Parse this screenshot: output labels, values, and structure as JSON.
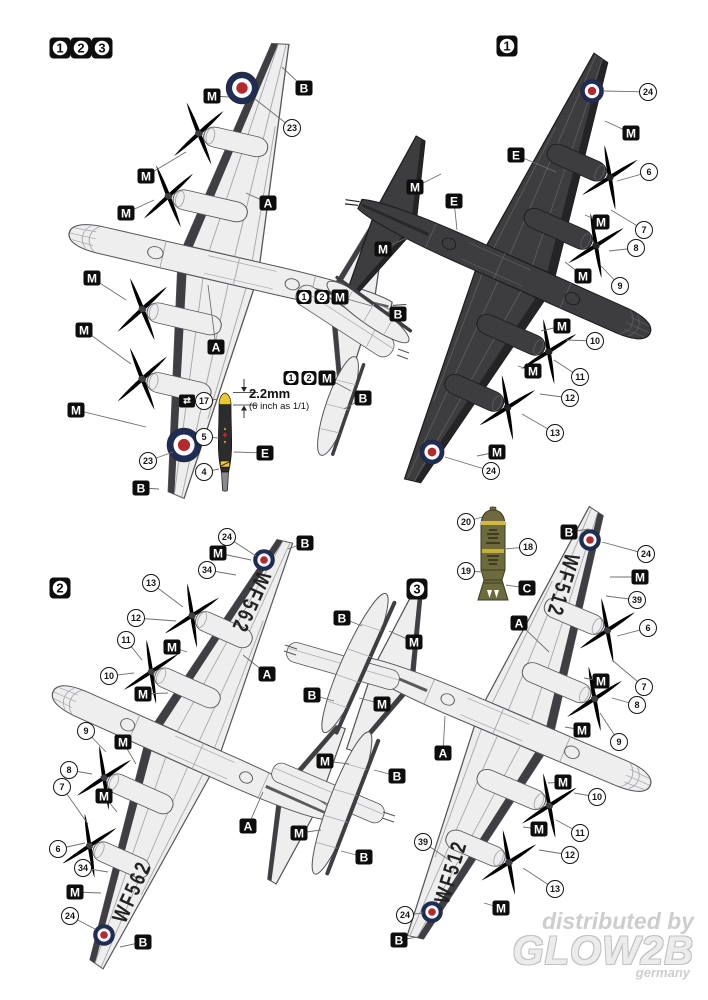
{
  "colors": {
    "page_bg": "#ffffff",
    "plane_light": "#eeeeef",
    "plane_light_edge": "#3f3f43",
    "plane_light_line": "#a4a4aa",
    "plane_light_out": "#55555a",
    "plane_dark": "#3d3d40",
    "plane_dark_edge": "#242427",
    "plane_dark_line": "#5c5c61",
    "plane_dark_out": "#1c1c1f",
    "roundel_blue": "#1e2c58",
    "roundel_red": "#b4282e",
    "bomb_olive": "#6d6b3e",
    "bomb_band": "#d2bb3a",
    "prop_dark": "#2c2c2f",
    "prop_tip": "#e9c832",
    "label_bg": "#0d0d0d",
    "label_fg": "#ffffff",
    "leader": "#6f6f6f",
    "watermark": "#cdcdcd"
  },
  "dimension": {
    "value": "2.2mm",
    "note": "(6 inch as 1/1)"
  },
  "watermark": {
    "distributed": "distributed by",
    "brand": "GLOW2B",
    "country": "germany"
  },
  "serials": [
    {
      "text": "WF562",
      "x": 250,
      "y": 602,
      "rot": 114
    },
    {
      "text": "WF562",
      "x": 133,
      "y": 892,
      "rot": -66
    },
    {
      "text": "WF512",
      "x": 562,
      "y": 585,
      "rot": 107
    },
    {
      "text": "WF512",
      "x": 452,
      "y": 872,
      "rot": -73
    }
  ],
  "callouts": [
    {
      "t": "section",
      "l": "1",
      "x": 60,
      "y": 48
    },
    {
      "t": "section",
      "l": "2",
      "x": 81,
      "y": 48
    },
    {
      "t": "section",
      "l": "3",
      "x": 102,
      "y": 48
    },
    {
      "t": "section",
      "l": "1",
      "x": 507,
      "y": 46
    },
    {
      "t": "section",
      "l": "2",
      "x": 60,
      "y": 588
    },
    {
      "t": "section",
      "l": "3",
      "x": 417,
      "y": 589
    },
    {
      "t": "box",
      "l": "M",
      "x": 212,
      "y": 96,
      "tx": 229,
      "ty": 97
    },
    {
      "t": "box",
      "l": "B",
      "x": 304,
      "y": 88,
      "tx": 282,
      "ty": 67
    },
    {
      "t": "circle",
      "l": "23",
      "x": 292,
      "y": 128,
      "tx": 255,
      "ty": 99
    },
    {
      "t": "box",
      "l": "A",
      "x": 268,
      "y": 203,
      "tx": 246,
      "ty": 193
    },
    {
      "t": "box",
      "l": "M",
      "x": 146,
      "y": 176,
      "tx": 186,
      "ty": 152
    },
    {
      "t": "box",
      "l": "M",
      "x": 126,
      "y": 213,
      "tx": 154,
      "ty": 200
    },
    {
      "t": "box",
      "l": "M",
      "x": 92,
      "y": 278,
      "tx": 126,
      "ty": 300
    },
    {
      "t": "box",
      "l": "M",
      "x": 84,
      "y": 330,
      "tx": 131,
      "ty": 364
    },
    {
      "t": "box",
      "l": "M",
      "x": 76,
      "y": 410,
      "tx": 146,
      "ty": 427
    },
    {
      "t": "circle",
      "l": "23",
      "x": 148,
      "y": 461,
      "tx": 173,
      "ty": 452
    },
    {
      "t": "box",
      "l": "B",
      "x": 141,
      "y": 488,
      "tx": 159,
      "ty": 489
    },
    {
      "t": "box",
      "l": "A",
      "x": 216,
      "y": 347,
      "tx": 208,
      "ty": 285
    },
    {
      "t": "numbox",
      "l": "1",
      "x": 304,
      "y": 297
    },
    {
      "t": "numbox",
      "l": "2",
      "x": 322,
      "y": 297
    },
    {
      "t": "box",
      "l": "M",
      "x": 340,
      "y": 297,
      "tx": 372,
      "ty": 306
    },
    {
      "t": "box",
      "l": "B",
      "x": 398,
      "y": 314,
      "tx": 377,
      "ty": 303
    },
    {
      "t": "numbox",
      "l": "1",
      "x": 291,
      "y": 378
    },
    {
      "t": "numbox",
      "l": "2",
      "x": 309,
      "y": 378
    },
    {
      "t": "box",
      "l": "M",
      "x": 327,
      "y": 378,
      "tx": 351,
      "ty": 391
    },
    {
      "t": "box",
      "l": "B",
      "x": 363,
      "y": 398,
      "tx": 344,
      "ty": 409
    },
    {
      "t": "decal",
      "l": "⇄",
      "x": 187,
      "y": 401
    },
    {
      "t": "circle",
      "l": "17",
      "x": 204,
      "y": 401,
      "tx": 218,
      "ty": 399
    },
    {
      "t": "circle",
      "l": "5",
      "x": 204,
      "y": 437,
      "tx": 219,
      "ty": 438
    },
    {
      "t": "box",
      "l": "E",
      "x": 265,
      "y": 453,
      "tx": 234,
      "ty": 452
    },
    {
      "t": "circle",
      "l": "4",
      "x": 204,
      "y": 472,
      "tx": 219,
      "ty": 469
    },
    {
      "t": "circle",
      "l": "24",
      "x": 648,
      "y": 92,
      "tx": 603,
      "ty": 91
    },
    {
      "t": "box",
      "l": "M",
      "x": 631,
      "y": 133,
      "tx": 605,
      "ty": 121
    },
    {
      "t": "box",
      "l": "E",
      "x": 516,
      "y": 155,
      "tx": 556,
      "ty": 172
    },
    {
      "t": "circle",
      "l": "6",
      "x": 649,
      "y": 172,
      "tx": 617,
      "ty": 181
    },
    {
      "t": "circle",
      "l": "7",
      "x": 644,
      "y": 230,
      "tx": 611,
      "ty": 210
    },
    {
      "t": "box",
      "l": "M",
      "x": 601,
      "y": 222,
      "tx": 585,
      "ty": 215
    },
    {
      "t": "circle",
      "l": "8",
      "x": 636,
      "y": 248,
      "tx": 609,
      "ty": 251
    },
    {
      "t": "circle",
      "l": "9",
      "x": 620,
      "y": 286,
      "tx": 601,
      "ty": 266
    },
    {
      "t": "box",
      "l": "M",
      "x": 583,
      "y": 276,
      "tx": 565,
      "ty": 262
    },
    {
      "t": "box",
      "l": "M",
      "x": 415,
      "y": 187,
      "tx": 441,
      "ty": 174
    },
    {
      "t": "box",
      "l": "E",
      "x": 454,
      "y": 201,
      "tx": 457,
      "ty": 230
    },
    {
      "t": "box",
      "l": "M",
      "x": 383,
      "y": 249,
      "tx": 406,
      "ty": 238
    },
    {
      "t": "box",
      "l": "M",
      "x": 562,
      "y": 326,
      "tx": 541,
      "ty": 331
    },
    {
      "t": "circle",
      "l": "10",
      "x": 595,
      "y": 341,
      "tx": 566,
      "ty": 340
    },
    {
      "t": "circle",
      "l": "11",
      "x": 580,
      "y": 377,
      "tx": 554,
      "ty": 360
    },
    {
      "t": "box",
      "l": "M",
      "x": 533,
      "y": 371,
      "tx": 518,
      "ty": 366
    },
    {
      "t": "circle",
      "l": "12",
      "x": 570,
      "y": 398,
      "tx": 540,
      "ty": 394
    },
    {
      "t": "circle",
      "l": "13",
      "x": 555,
      "y": 433,
      "tx": 522,
      "ty": 414
    },
    {
      "t": "box",
      "l": "M",
      "x": 497,
      "y": 452,
      "tx": 477,
      "ty": 456
    },
    {
      "t": "circle",
      "l": "24",
      "x": 491,
      "y": 471,
      "tx": 445,
      "ty": 457
    },
    {
      "t": "circle",
      "l": "20",
      "x": 466,
      "y": 522,
      "tx": 482,
      "ty": 517
    },
    {
      "t": "circle",
      "l": "18",
      "x": 528,
      "y": 547,
      "tx": 504,
      "ty": 549
    },
    {
      "t": "circle",
      "l": "19",
      "x": 466,
      "y": 571,
      "tx": 483,
      "ty": 572
    },
    {
      "t": "box",
      "l": "C",
      "x": 527,
      "y": 588,
      "tx": 506,
      "ty": 585
    },
    {
      "t": "circle",
      "l": "24",
      "x": 227,
      "y": 537,
      "tx": 256,
      "ty": 556
    },
    {
      "t": "box",
      "l": "M",
      "x": 218,
      "y": 553,
      "tx": 251,
      "ty": 560
    },
    {
      "t": "circle",
      "l": "34",
      "x": 207,
      "y": 570,
      "tx": 236,
      "ty": 575
    },
    {
      "t": "box",
      "l": "B",
      "x": 305,
      "y": 543,
      "tx": 288,
      "ty": 549
    },
    {
      "t": "circle",
      "l": "13",
      "x": 151,
      "y": 583,
      "tx": 183,
      "ty": 607
    },
    {
      "t": "circle",
      "l": "12",
      "x": 136,
      "y": 618,
      "tx": 176,
      "ty": 621
    },
    {
      "t": "circle",
      "l": "11",
      "x": 126,
      "y": 640,
      "tx": 142,
      "ty": 660
    },
    {
      "t": "circle",
      "l": "10",
      "x": 109,
      "y": 676,
      "tx": 134,
      "ty": 673
    },
    {
      "t": "box",
      "l": "M",
      "x": 172,
      "y": 647,
      "tx": 187,
      "ty": 652
    },
    {
      "t": "box",
      "l": "M",
      "x": 143,
      "y": 694,
      "tx": 168,
      "ty": 693
    },
    {
      "t": "box",
      "l": "A",
      "x": 267,
      "y": 674,
      "tx": 243,
      "ty": 655
    },
    {
      "t": "circle",
      "l": "9",
      "x": 86,
      "y": 731,
      "tx": 106,
      "ty": 752
    },
    {
      "t": "box",
      "l": "M",
      "x": 123,
      "y": 742,
      "tx": 136,
      "ty": 764
    },
    {
      "t": "circle",
      "l": "8",
      "x": 69,
      "y": 770,
      "tx": 92,
      "ty": 774
    },
    {
      "t": "circle",
      "l": "7",
      "x": 62,
      "y": 787,
      "tx": 88,
      "ty": 824
    },
    {
      "t": "box",
      "l": "M",
      "x": 104,
      "y": 796,
      "tx": 117,
      "ty": 812
    },
    {
      "t": "circle",
      "l": "6",
      "x": 58,
      "y": 849,
      "tx": 85,
      "ty": 843
    },
    {
      "t": "circle",
      "l": "34",
      "x": 83,
      "y": 868,
      "tx": 108,
      "ty": 872
    },
    {
      "t": "box",
      "l": "M",
      "x": 75,
      "y": 892,
      "tx": 101,
      "ty": 893
    },
    {
      "t": "circle",
      "l": "24",
      "x": 70,
      "y": 916,
      "tx": 95,
      "ty": 929
    },
    {
      "t": "box",
      "l": "B",
      "x": 143,
      "y": 942,
      "tx": 120,
      "ty": 947
    },
    {
      "t": "box",
      "l": "A",
      "x": 248,
      "y": 826,
      "tx": 263,
      "ty": 792
    },
    {
      "t": "box",
      "l": "B",
      "x": 342,
      "y": 618,
      "tx": 362,
      "ty": 626
    },
    {
      "t": "box",
      "l": "M",
      "x": 414,
      "y": 642,
      "tx": 389,
      "ty": 631
    },
    {
      "t": "box",
      "l": "B",
      "x": 312,
      "y": 695,
      "tx": 334,
      "ty": 701
    },
    {
      "t": "box",
      "l": "M",
      "x": 382,
      "y": 704,
      "tx": 359,
      "ty": 698
    },
    {
      "t": "box",
      "l": "M",
      "x": 325,
      "y": 761,
      "tx": 349,
      "ty": 764
    },
    {
      "t": "box",
      "l": "B",
      "x": 397,
      "y": 776,
      "tx": 374,
      "ty": 770
    },
    {
      "t": "box",
      "l": "M",
      "x": 299,
      "y": 833,
      "tx": 321,
      "ty": 830
    },
    {
      "t": "box",
      "l": "B",
      "x": 364,
      "y": 857,
      "tx": 341,
      "ty": 851
    },
    {
      "t": "box",
      "l": "B",
      "x": 569,
      "y": 532,
      "tx": 589,
      "ty": 529
    },
    {
      "t": "circle",
      "l": "24",
      "x": 646,
      "y": 554,
      "tx": 602,
      "ty": 542
    },
    {
      "t": "box",
      "l": "M",
      "x": 640,
      "y": 577,
      "tx": 610,
      "ty": 577
    },
    {
      "t": "circle",
      "l": "39",
      "x": 637,
      "y": 600,
      "tx": 606,
      "ty": 596
    },
    {
      "t": "box",
      "l": "A",
      "x": 519,
      "y": 623,
      "tx": 549,
      "ty": 652
    },
    {
      "t": "circle",
      "l": "6",
      "x": 648,
      "y": 628,
      "tx": 617,
      "ty": 636
    },
    {
      "t": "circle",
      "l": "7",
      "x": 644,
      "y": 687,
      "tx": 612,
      "ty": 660
    },
    {
      "t": "box",
      "l": "M",
      "x": 601,
      "y": 681,
      "tx": 584,
      "ty": 678
    },
    {
      "t": "circle",
      "l": "8",
      "x": 637,
      "y": 705,
      "tx": 612,
      "ty": 698
    },
    {
      "t": "circle",
      "l": "9",
      "x": 619,
      "y": 742,
      "tx": 600,
      "ty": 713
    },
    {
      "t": "box",
      "l": "M",
      "x": 582,
      "y": 730,
      "tx": 565,
      "ty": 727
    },
    {
      "t": "box",
      "l": "A",
      "x": 443,
      "y": 753,
      "tx": 445,
      "ty": 716
    },
    {
      "t": "box",
      "l": "M",
      "x": 563,
      "y": 782,
      "tx": 548,
      "ty": 783
    },
    {
      "t": "circle",
      "l": "10",
      "x": 597,
      "y": 797,
      "tx": 574,
      "ty": 793
    },
    {
      "t": "circle",
      "l": "11",
      "x": 580,
      "y": 833,
      "tx": 556,
      "ty": 820
    },
    {
      "t": "box",
      "l": "M",
      "x": 539,
      "y": 829,
      "tx": 523,
      "ty": 827
    },
    {
      "t": "circle",
      "l": "12",
      "x": 570,
      "y": 855,
      "tx": 539,
      "ty": 850
    },
    {
      "t": "circle",
      "l": "13",
      "x": 555,
      "y": 889,
      "tx": 523,
      "ty": 868
    },
    {
      "t": "circle",
      "l": "39",
      "x": 423,
      "y": 842,
      "tx": 452,
      "ty": 862
    },
    {
      "t": "box",
      "l": "M",
      "x": 501,
      "y": 908,
      "tx": 484,
      "ty": 903
    },
    {
      "t": "circle",
      "l": "24",
      "x": 405,
      "y": 915,
      "tx": 423,
      "ty": 913
    },
    {
      "t": "box",
      "l": "B",
      "x": 399,
      "y": 940,
      "tx": 418,
      "ty": 937
    }
  ]
}
